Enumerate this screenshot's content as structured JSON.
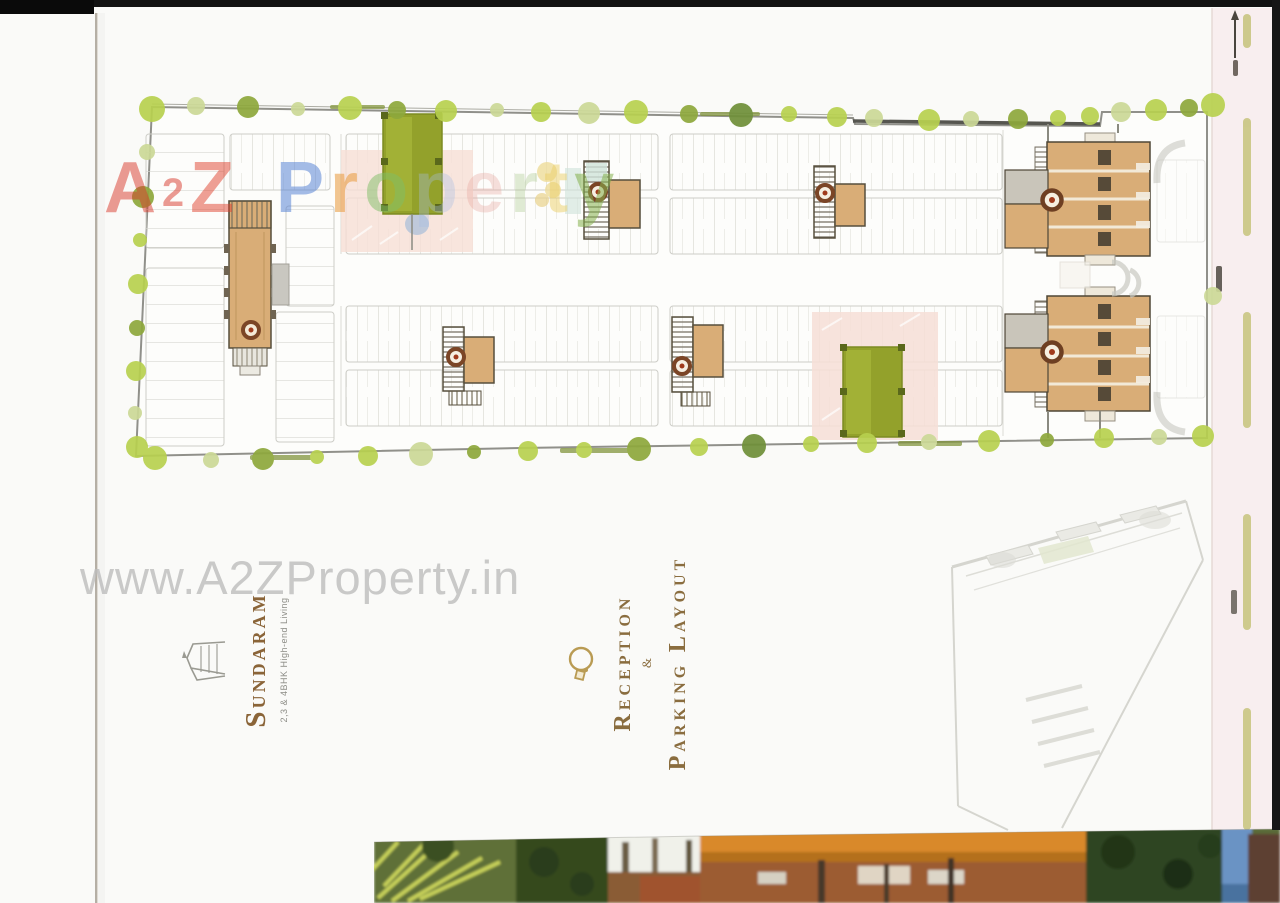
{
  "palette": {
    "tan": "#d9ad77",
    "lawn": "#93a12b",
    "lawn_light": "#a6b53a",
    "lawn_knob": "#5a681b",
    "plaza": "#f6ded6",
    "road_pink": "#f8eeef",
    "dash": "#c9c582",
    "boundary": "#90908a",
    "stall": "#d8d8d2",
    "core_outline": "#564f3d",
    "stair_ring": "#7b4526",
    "bronze": "#8a6438",
    "gold": "#b99b53",
    "wm_gray": "#bdbdbd",
    "tree_bright": "#b8d14f",
    "tree_olive": "#8ea83c",
    "tree_pale": "#ccd997",
    "tree_dark": "#6f8f38"
  },
  "watermark_top": {
    "text": "A2Z Property",
    "letters": [
      {
        "ch": "A",
        "c": "#d93a2c",
        "op": 0.5
      },
      {
        "ch": "2",
        "c": "#d93a2c",
        "op": 0.5,
        "s": 0.55,
        "va": "0.14em"
      },
      {
        "ch": "Z",
        "c": "#e0432f",
        "op": 0.5
      },
      {
        "ch": " "
      },
      {
        "ch": "P",
        "c": "#5b86d6",
        "op": 0.55
      },
      {
        "ch": "r",
        "c": "#e8993a",
        "op": 0.55
      },
      {
        "ch": "o",
        "c": "#7fbe66",
        "op": 0.5
      },
      {
        "ch": "p",
        "c": "#a9bfe4",
        "op": 0.35
      },
      {
        "ch": "e",
        "c": "#e8a59e",
        "op": 0.35
      },
      {
        "ch": "r",
        "c": "#a9c98a",
        "op": 0.35
      },
      {
        "ch": "t",
        "c": "#ecd06a",
        "op": 0.5
      },
      {
        "ch": "y",
        "c": "#86b24e",
        "op": 0.55
      }
    ]
  },
  "watermark_mid": {
    "text": "www.A2ZProperty.in"
  },
  "brand": {
    "name": "Sundaram",
    "tagline": "2,3 & 4BHK High-end Living"
  },
  "title": {
    "line1": "Reception",
    "amp": "&",
    "word1": "Parking",
    "word2": "Layout"
  }
}
